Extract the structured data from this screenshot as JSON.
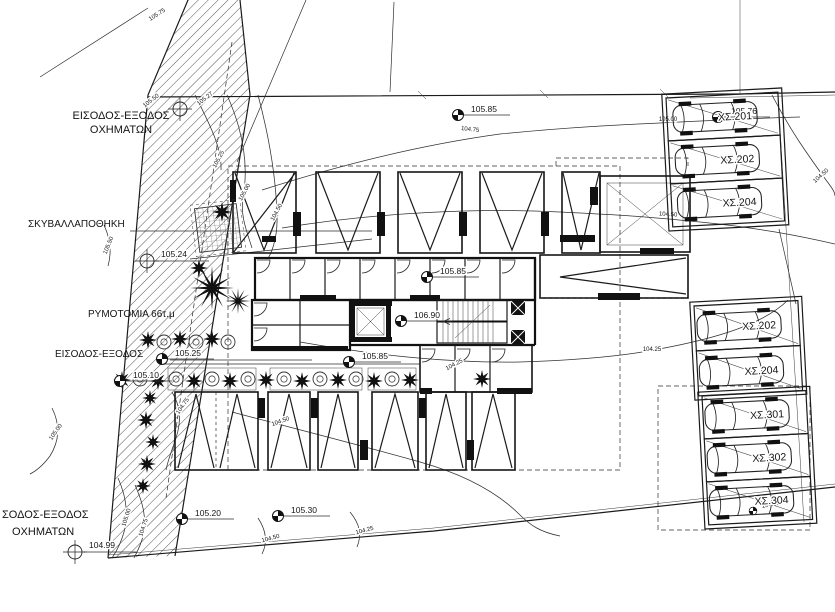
{
  "drawing": {
    "title": "site-plan-ground-floor",
    "colors": {
      "ink": "#1b1b1b",
      "paper": "#ffffff"
    },
    "site_labels": [
      {
        "text": "ΕΙΣΟΔΟΣ-ΕΞΟΔΟΣ"
      },
      {
        "text": "ΟΧΗΜΑΤΩΝ"
      },
      {
        "text": "ΣΚΥΒΑΛΛΑΠΟΘΗΚΗ"
      },
      {
        "text": "ΡΥΜΟΤΟΜΙΑ 66τ.μ"
      },
      {
        "text": "ΕΙΣΟΔΟΣ-ΕΞΟΔΟΣ"
      },
      {
        "text": "ΣΟΔΟΣ-ΕΞΟΔΟΣ"
      },
      {
        "text": "ΟΧΗΜΑΤΩΝ"
      }
    ],
    "spot_elevations": [
      {
        "value": "105.85",
        "x": 458,
        "y": 115
      },
      {
        "value": "105.85",
        "x": 427,
        "y": 277
      },
      {
        "value": "106.90",
        "x": 401,
        "y": 321
      },
      {
        "value": "105.85",
        "x": 349,
        "y": 362
      },
      {
        "value": "105.25",
        "x": 162,
        "y": 359
      },
      {
        "value": "105.10",
        "x": 120,
        "y": 381
      },
      {
        "value": "105.20",
        "x": 182,
        "y": 519
      },
      {
        "value": "105.30",
        "x": 278,
        "y": 516
      },
      {
        "value": "105.76",
        "x": 718,
        "y": 117
      },
      {
        "value": "104.50",
        "x": 753,
        "y": 511,
        "small": true
      }
    ],
    "survey_points": [
      {
        "x": 180,
        "y": 109
      },
      {
        "value": "105.24",
        "x": 147,
        "y": 261
      },
      {
        "value": "104.99",
        "x": 75,
        "y": 552
      }
    ],
    "contour_labels": [
      {
        "value": "105.75",
        "x": 158,
        "y": 16,
        "rot": -33
      },
      {
        "value": "105.50",
        "x": 152,
        "y": 102,
        "rot": -38
      },
      {
        "value": "105.27",
        "x": 206,
        "y": 100,
        "rot": -38
      },
      {
        "value": "105.25",
        "x": 220,
        "y": 160,
        "rot": -62
      },
      {
        "value": "105.00",
        "x": 246,
        "y": 193,
        "rot": -62
      },
      {
        "value": "104.50",
        "x": 278,
        "y": 213,
        "rot": -62
      },
      {
        "value": "104.75",
        "x": 470,
        "y": 131,
        "rot": 6
      },
      {
        "value": "105.50",
        "x": 110,
        "y": 246,
        "rot": -68
      },
      {
        "value": "105.00",
        "x": 57,
        "y": 433,
        "rot": -55
      },
      {
        "value": "104.75",
        "x": 184,
        "y": 407,
        "rot": -55
      },
      {
        "value": "104.50",
        "x": 281,
        "y": 423,
        "rot": -20
      },
      {
        "value": "104.50",
        "x": 668,
        "y": 216,
        "rot": 4
      },
      {
        "value": "104.50",
        "x": 822,
        "y": 177,
        "rot": -42
      },
      {
        "value": "104.25",
        "x": 652,
        "y": 351,
        "rot": 0
      },
      {
        "value": "104.25",
        "x": 455,
        "y": 366,
        "rot": -28
      },
      {
        "value": "105.00",
        "x": 128,
        "y": 518,
        "rot": -72
      },
      {
        "value": "104.75",
        "x": 145,
        "y": 528,
        "rot": -72
      },
      {
        "value": "104.50",
        "x": 271,
        "y": 540,
        "rot": -15
      },
      {
        "value": "104.25",
        "x": 365,
        "y": 532,
        "rot": -15
      },
      {
        "value": "105.00",
        "x": 668,
        "y": 121,
        "rot": 0
      }
    ],
    "parking": {
      "groups": [
        {
          "x": 666,
          "y": 98,
          "w": 112,
          "h": 129,
          "rot": -3,
          "stalls": [
            "ΧΣ.201",
            "ΧΣ.202",
            "ΧΣ.204"
          ]
        },
        {
          "x": 694,
          "y": 306,
          "w": 104,
          "h": 90,
          "rot": -3,
          "stalls": [
            "ΧΣ.202",
            "ΧΣ.204"
          ]
        },
        {
          "x": 702,
          "y": 396,
          "w": 104,
          "h": 129,
          "rot": -3,
          "stalls": [
            "ΧΣ.301",
            "ΧΣ.302",
            "ΧΣ.304"
          ]
        }
      ]
    },
    "vegetation": [
      [
        148,
        340,
        9,
        "s"
      ],
      [
        164,
        342,
        7,
        "c"
      ],
      [
        180,
        339,
        9,
        "s"
      ],
      [
        196,
        342,
        7,
        "c"
      ],
      [
        212,
        339,
        9,
        "s"
      ],
      [
        228,
        342,
        7,
        "c"
      ],
      [
        122,
        380,
        9,
        "s"
      ],
      [
        140,
        379,
        7,
        "c"
      ],
      [
        158,
        381,
        9,
        "s"
      ],
      [
        176,
        379,
        7,
        "c"
      ],
      [
        194,
        381,
        9,
        "s"
      ],
      [
        212,
        379,
        7,
        "c"
      ],
      [
        230,
        381,
        9,
        "s"
      ],
      [
        248,
        379,
        7,
        "c"
      ],
      [
        266,
        380,
        9,
        "s"
      ],
      [
        284,
        379,
        7,
        "c"
      ],
      [
        302,
        381,
        9,
        "s"
      ],
      [
        320,
        379,
        7,
        "c"
      ],
      [
        338,
        380,
        9,
        "s"
      ],
      [
        356,
        379,
        7,
        "c"
      ],
      [
        374,
        381,
        9,
        "s"
      ],
      [
        392,
        379,
        7,
        "c"
      ],
      [
        410,
        380,
        9,
        "s"
      ],
      [
        150,
        398,
        8,
        "s"
      ],
      [
        146,
        420,
        9,
        "s"
      ],
      [
        153,
        442,
        8,
        "s"
      ],
      [
        147,
        464,
        9,
        "s"
      ],
      [
        143,
        486,
        8,
        "s"
      ],
      [
        222,
        212,
        10,
        "s"
      ],
      [
        482,
        379,
        9,
        "s"
      ],
      [
        212,
        288,
        22,
        "p"
      ],
      [
        238,
        301,
        13,
        "p"
      ],
      [
        199,
        268,
        9,
        "s"
      ]
    ]
  }
}
